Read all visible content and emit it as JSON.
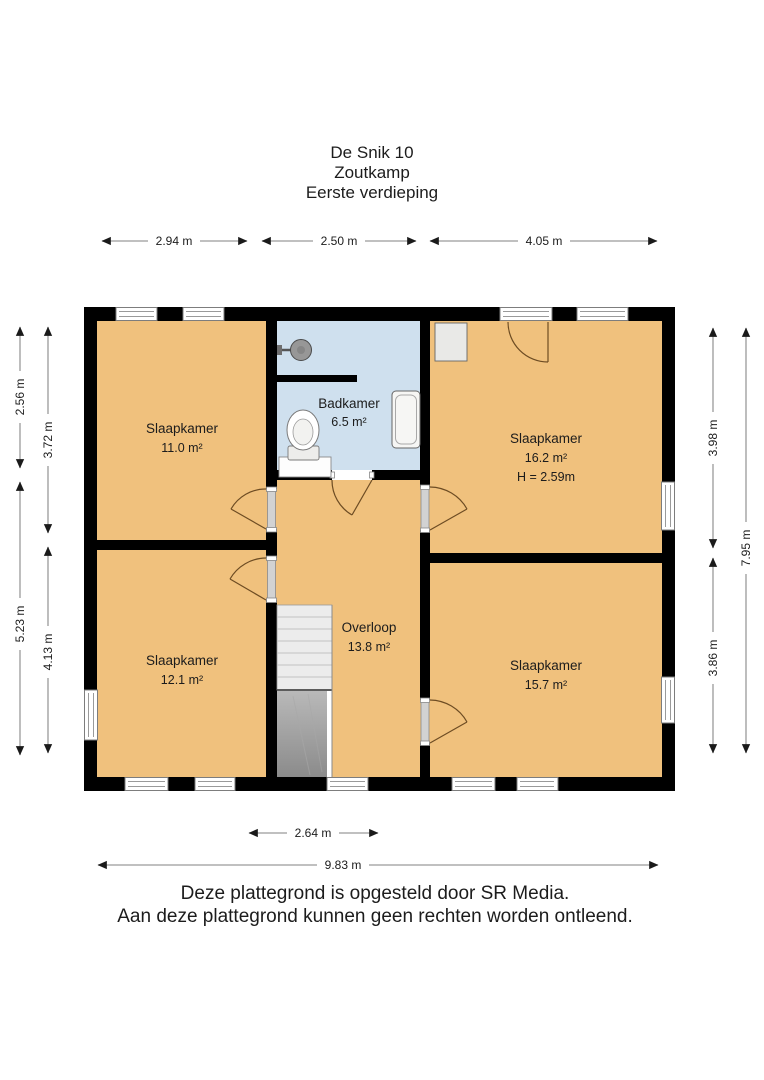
{
  "title": {
    "lines": [
      "De Snik 10",
      "Zoutkamp",
      "Eerste verdieping"
    ]
  },
  "rooms": {
    "slaapkamer_11": {
      "name": "Slaapkamer",
      "area": "11.0 m²"
    },
    "badkamer": {
      "name": "Badkamer",
      "area": "6.5 m²"
    },
    "slaapkamer_16": {
      "name": "Slaapkamer",
      "area": "16.2 m²",
      "ceiling_height": "H = 2.59m"
    },
    "overloop": {
      "name": "Overloop",
      "area": "13.8 m²"
    },
    "slaapkamer_12": {
      "name": "Slaapkamer",
      "area": "12.1 m²"
    },
    "slaapkamer_15": {
      "name": "Slaapkamer",
      "area": "15.7 m²"
    }
  },
  "dimensions": {
    "top": [
      "2.94 m",
      "2.50 m",
      "4.05 m"
    ],
    "left_outer": [
      "2.56 m",
      "5.23 m"
    ],
    "left_inner": [
      "3.72 m",
      "4.13 m"
    ],
    "right_inner": [
      "3.98 m",
      "3.86 m"
    ],
    "right_outer": [
      "7.95 m"
    ],
    "bottom": [
      "2.64 m",
      "9.83 m"
    ]
  },
  "footer": {
    "lines": [
      "Deze plattegrond is opgesteld door SR Media.",
      "Aan deze plattegrond kunnen geen rechten worden ontleend."
    ]
  },
  "colors": {
    "floor": "#f0c17d",
    "bathroom": "#cfe0ee",
    "wall": "#000000"
  }
}
